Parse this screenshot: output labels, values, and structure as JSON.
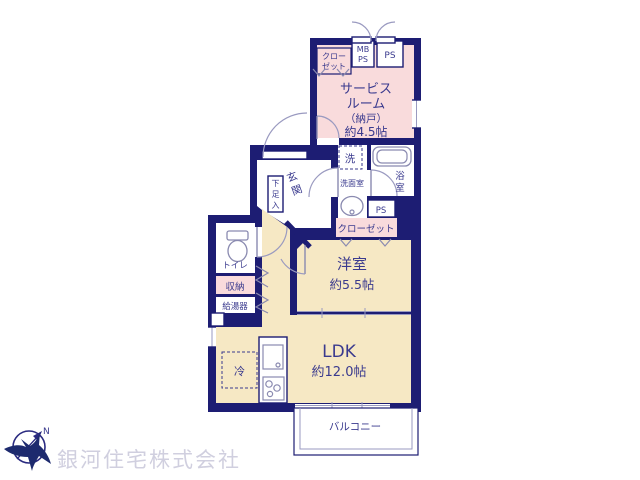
{
  "plan": {
    "upper": {
      "closet_l1": "クロー",
      "closet_l2": "ゼット",
      "mb_l1": "MB",
      "mb_l2": "PS",
      "ps": "PS",
      "service_room": {
        "l1": "サービス",
        "l2": "ルーム",
        "l3": "（納戸）",
        "l4": "約4.5帖"
      }
    },
    "mid": {
      "washer": "洗",
      "washroom": "洗面室",
      "bath_c1": "浴",
      "bath_c2": "室",
      "ps": "PS",
      "closet": "クローゼット",
      "genkan_c1": "玄",
      "genkan_c2": "関",
      "shoe_c1": "下",
      "shoe_c2": "足",
      "shoe_c3": "入"
    },
    "left": {
      "toilet": "トイレ",
      "storage": "収納",
      "heater": "給湯器"
    },
    "rooms": {
      "bedroom_name": "洋室",
      "bedroom_size": "約5.5帖",
      "ldk_name": "LDK",
      "ldk_size": "約12.0帖",
      "fridge": "冷",
      "balcony": "バルコニー"
    }
  },
  "branding": {
    "company": "銀河住宅株式会社",
    "compass_north": "N"
  },
  "colors": {
    "wall": "#1d1d73",
    "room_pink": "#f9dbdc",
    "room_cream": "#f6e8c4",
    "text": "#3a3a8e",
    "watermark": "#d0cfdf"
  }
}
